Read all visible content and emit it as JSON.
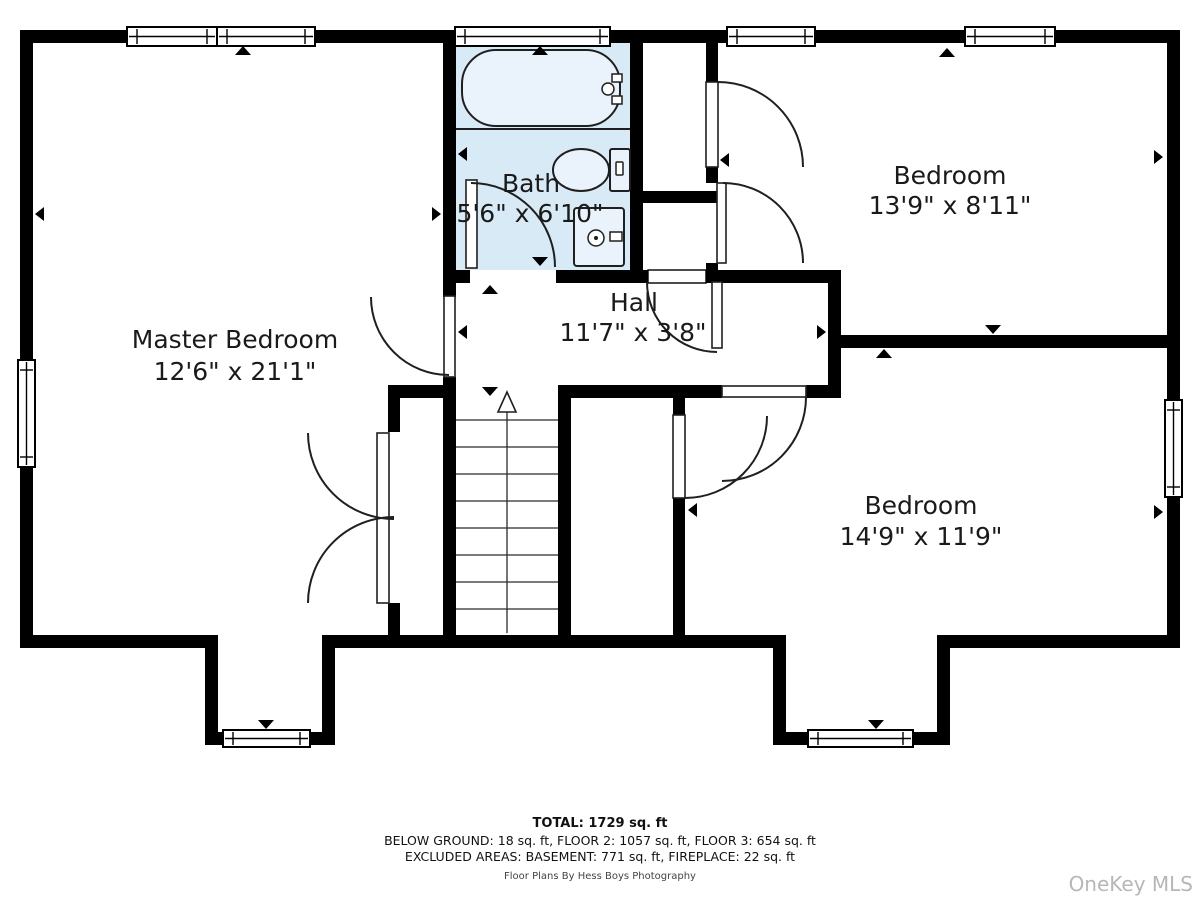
{
  "rooms": [
    {
      "name": "Master Bedroom",
      "dims": "12'6\" x 21'1\""
    },
    {
      "name": "Bath",
      "dims": "5'6\" x 6'10\""
    },
    {
      "name": "Hall",
      "dims": "11'7\" x 3'8\""
    },
    {
      "name": "Bedroom",
      "dims": "13'9\" x 8'11\""
    },
    {
      "name": "Bedroom",
      "dims": "14'9\" x 11'9\""
    }
  ],
  "summary": {
    "total": "TOTAL: 1729 sq. ft",
    "line2": "BELOW GROUND: 18 sq. ft, FLOOR 2: 1057 sq. ft, FLOOR 3: 654 sq. ft",
    "line3": "EXCLUDED AREAS: BASEMENT: 771 sq. ft, FIREPLACE: 22 sq. ft",
    "credit": "Floor Plans By Hess Boys Photography"
  },
  "watermark": "OneKey MLS",
  "colors": {
    "wall": "#000000",
    "bath_fill": "#d9eaf7",
    "fixture_fill": "#eaf3fb",
    "line": "#1f1f1f",
    "watermark": "#b7b7b7"
  }
}
